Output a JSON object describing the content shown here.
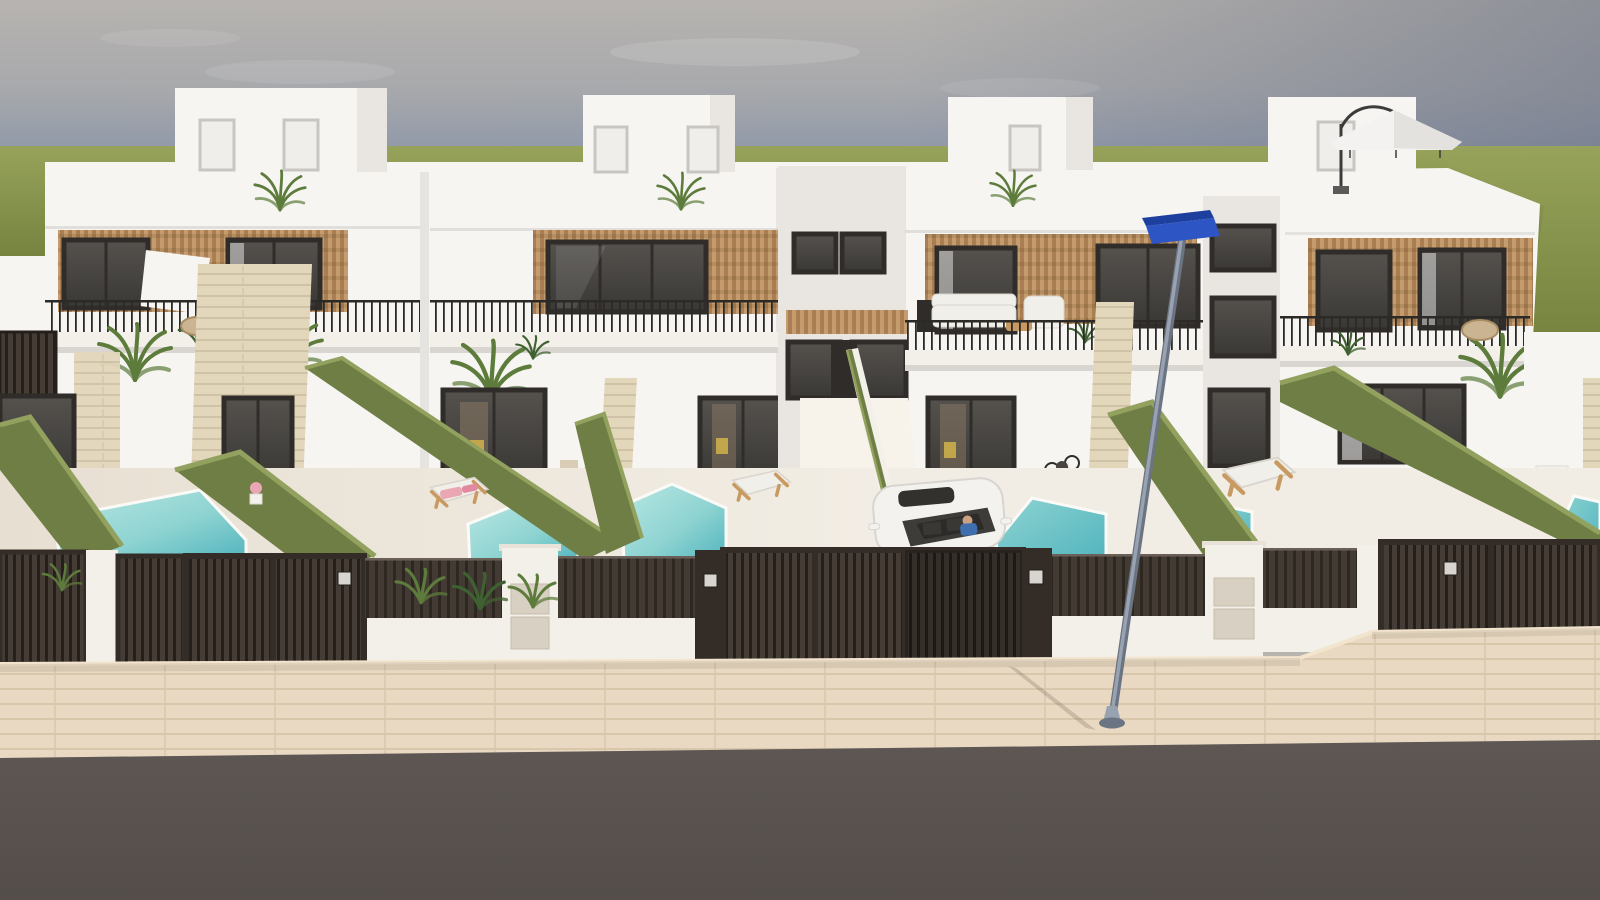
{
  "scene": {
    "type": "3d-architectural-render",
    "subject": "row of four modern white townhouses with private pools, dark slatted gates, sidewalk and road",
    "objects": {
      "sky": "sky_mid",
      "grass_horizon": "grass_light",
      "houses": "wall_white",
      "wood_cladding": "wood_light",
      "windows": "glass_dark",
      "balcony_railings": "railing_dark",
      "stone_columns": "stone_light",
      "hedge_walls": "hedge",
      "pools": "pool_deep",
      "terrace_floor": "floor_light",
      "fences_and_gates": "fence_dark",
      "mailbox_pillars": "pillar_white",
      "sun_loungers": "lounger_wood",
      "car": "car_white",
      "street_lamp": "lamp_blue",
      "umbrella": "umbrella_light",
      "plants": "plant_mid",
      "sidewalk": "sidewalk",
      "road": "road"
    },
    "counts": {
      "houses": 4,
      "visible_pools": 6,
      "gates": 6,
      "sun_loungers": 3,
      "cars": 1,
      "street_lamps": 1
    }
  },
  "colors": {
    "sky_top": "#b7b4b0",
    "sky_upper": "#a8a9ac",
    "sky_mid": "#8f98a9",
    "sky_violet": "#9e95a1",
    "sky_haze": "#b4abae",
    "sky_dark_corner": "#6b7284",
    "grass_light": "#97a35a",
    "grass_dark": "#75833f",
    "wall_white": "#f6f5f2",
    "wall_shade": "#e9e6e2",
    "wall_dark_shade": "#d9d6d2",
    "wood_light": "#c59c6d",
    "wood_dark": "#a87e52",
    "frame_dark": "#2f2c29",
    "glass_dark": "#3a3835",
    "glass_mid": "#55524e",
    "glass_warm": "#8a7a64",
    "railing_dark": "#2c2a27",
    "stone_light": "#e2d6bb",
    "stone_line": "#cfc2a6",
    "hedge": "#6e7e44",
    "hedge_light": "#93a15f",
    "hedge_dark": "#5c6c38",
    "pool_light": "#b9e7e3",
    "pool_mid": "#8fd4d2",
    "pool_deep": "#4fb3bd",
    "pool_edge": "#fbfaf7",
    "floor_light": "#f2ede4",
    "floor_shade": "#e7dfd2",
    "floor_bright": "#f7f3ea",
    "fence_dark": "#342d27",
    "fence_slat": "#453d35",
    "fence_slat_dark": "#241f1b",
    "fence_slat_mid": "#423a33",
    "fence_gap": "#2d2722",
    "fence_top_hl": "#6a6058",
    "pillar_white": "#f3f0ea",
    "mailbox_panel": "#d9d0c4",
    "plaque_light": "#d8d4cf",
    "plaque_dark": "#3a3531",
    "sidewalk": "#ead9c2",
    "sidewalk_line": "#d9c7ac",
    "sidewalk_edge": "#f2e4cd",
    "road": "#5e5753",
    "road_dark": "#544d49",
    "pole_light": "#98a2b0",
    "pole_dark": "#6a7482",
    "lamp_blue": "#2e55c4",
    "lamp_blue_dark": "#1d3f9e",
    "car_white": "#f3f2ef",
    "car_shade": "#d8d5d1",
    "car_glass": "#3e3c39",
    "car_interior": "#2c2b29",
    "driver_shirt": "#3f6fae",
    "driver_skin": "#caa183",
    "lounger_wood": "#c89a62",
    "cushion_white": "#f1efe9",
    "towel_pink": "#eba6b4",
    "towel_pink_dark": "#e189a0",
    "plant_mid": "#5d7c3c",
    "plant_dark": "#3f6030",
    "plant_bright": "#8fb546",
    "pot_white": "#f4f2ed",
    "pot_beige": "#d9cdb8",
    "umbrella_light": "#f3f2f0",
    "umbrella_shade": "#e4e2df",
    "umbrella_arm": "#3c3c3c"
  }
}
